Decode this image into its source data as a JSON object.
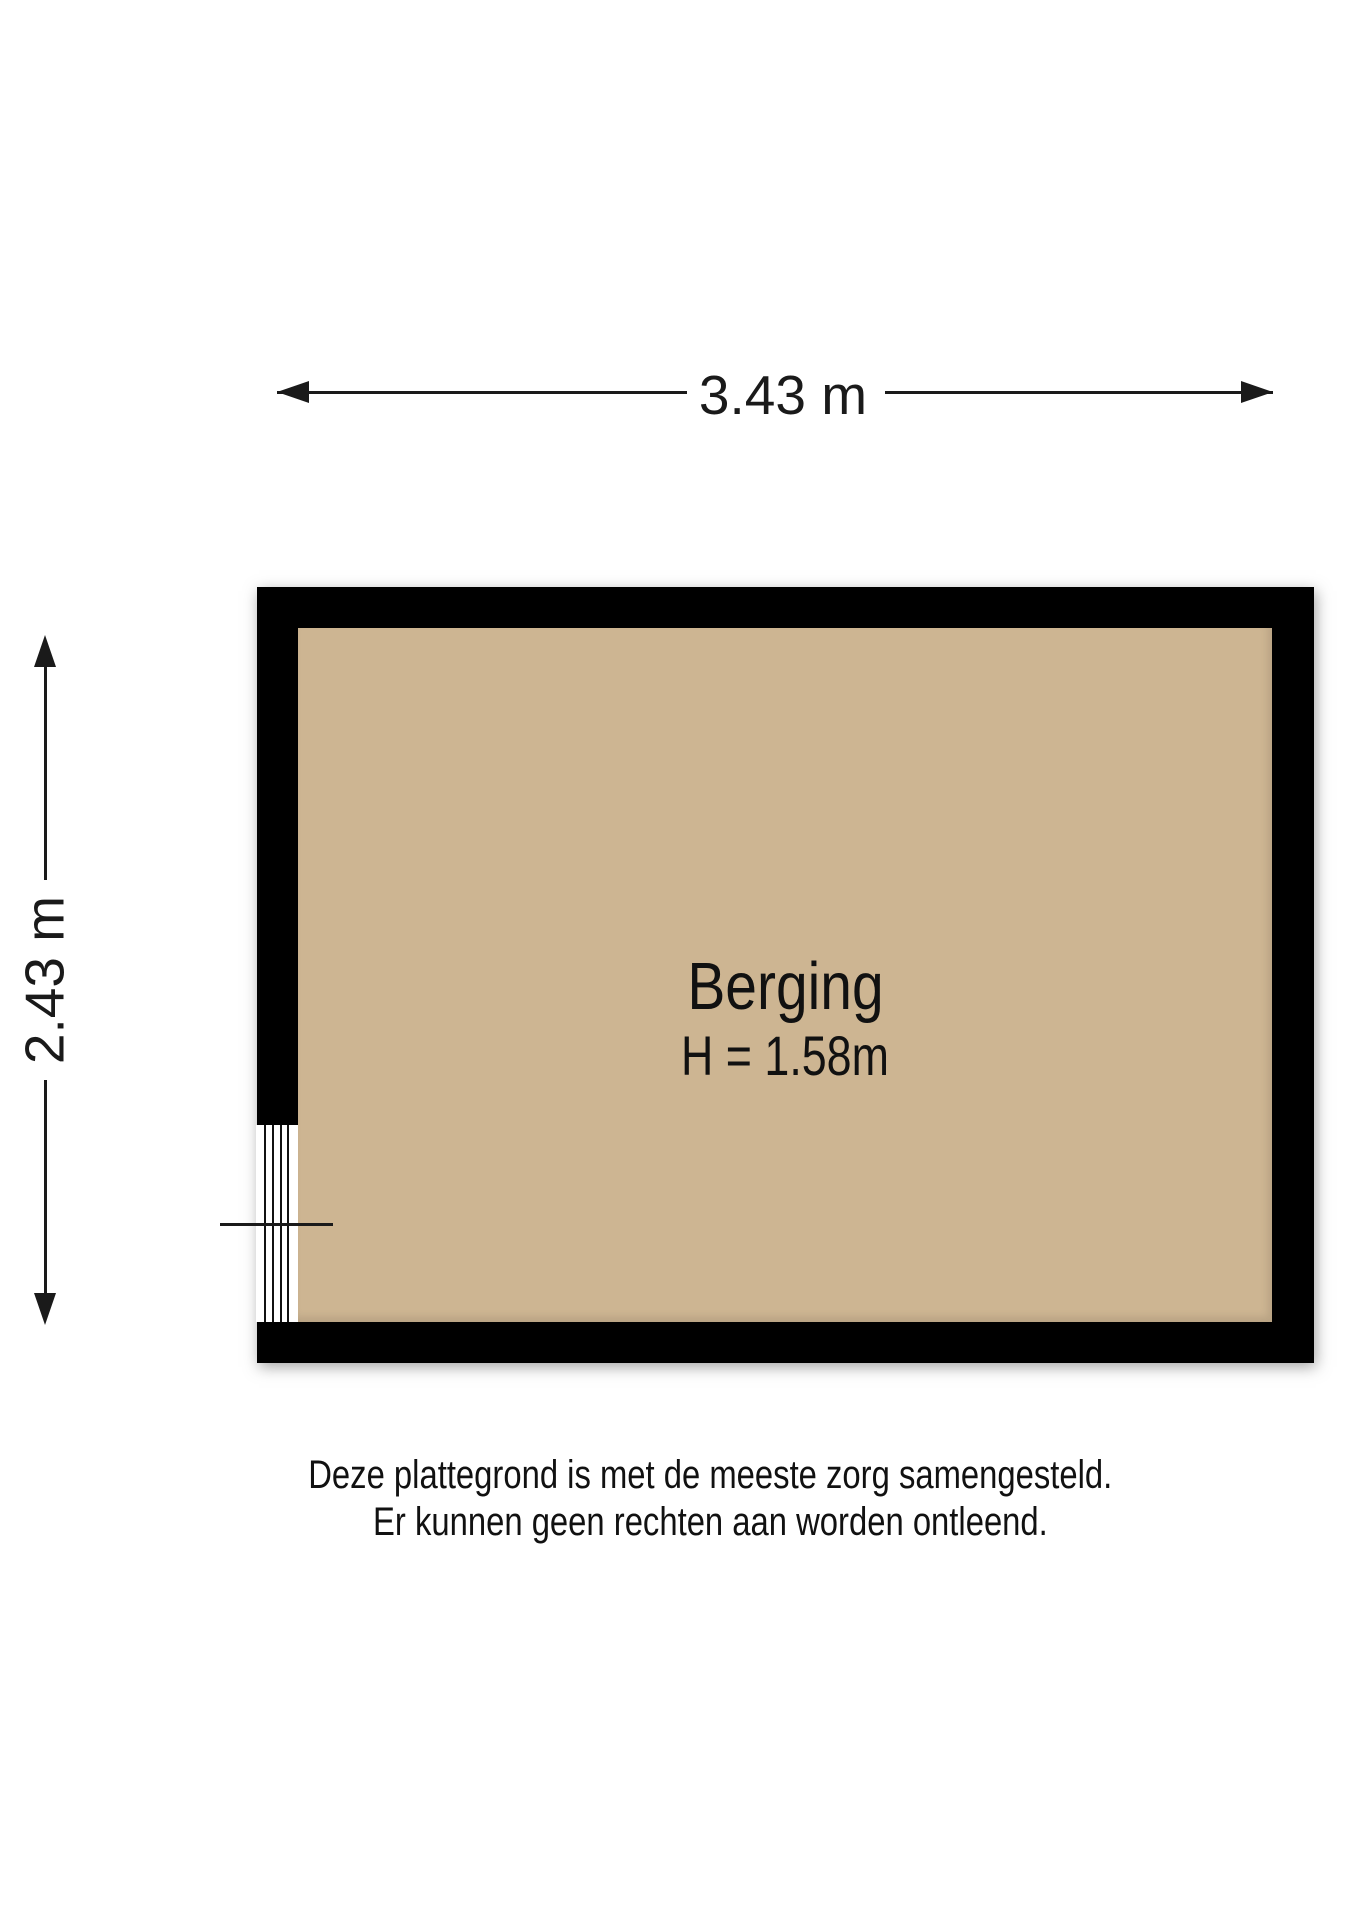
{
  "room": {
    "name": "Berging",
    "ceiling_height": "H = 1.58m"
  },
  "dimensions": {
    "width": "3.43 m",
    "depth": "2.43 m"
  },
  "disclaimer": {
    "line1": "Deze plattegrond is met de meeste zorg samengesteld.",
    "line2": "Er kunnen geen rechten aan worden ontleend."
  },
  "colors": {
    "wall": "#000000",
    "floor": "#cdb592",
    "dimension_line": "#1a1a1a",
    "background": "#ffffff"
  }
}
